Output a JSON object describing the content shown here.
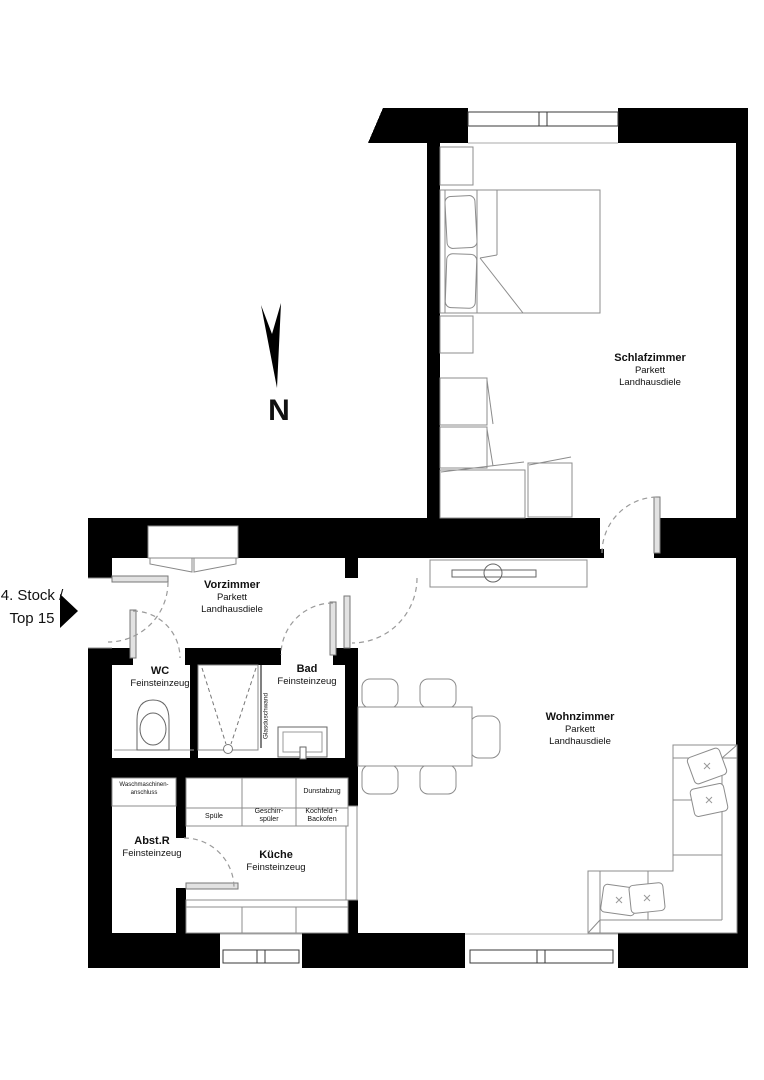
{
  "plan": {
    "floor": {
      "line1": "4. Stock /",
      "line2": "Top 15"
    },
    "north": "N",
    "rooms": {
      "schlafzimmer": {
        "name": "Schlafzimmer",
        "material1": "Parkett",
        "material2": "Landhausdiele"
      },
      "wohnzimmer": {
        "name": "Wohnzimmer",
        "material1": "Parkett",
        "material2": "Landhausdiele"
      },
      "vorzimmer": {
        "name": "Vorzimmer",
        "material1": "Parkett",
        "material2": "Landhausdiele"
      },
      "wc": {
        "name": "WC",
        "material1": "Feinsteinzeug"
      },
      "bad": {
        "name": "Bad",
        "material1": "Feinsteinzeug"
      },
      "abstr": {
        "name": "Abst.R",
        "material1": "Feinsteinzeug"
      },
      "kueche": {
        "name": "Küche",
        "material1": "Feinsteinzeug"
      }
    },
    "kitchen": {
      "spuele": "Spüle",
      "geschirr1": "Geschirr-",
      "geschirr2": "spüler",
      "dunstabzug": "Dunstabzug",
      "kochfeld1": "Kochfeld +",
      "kochfeld2": "Backofen",
      "wasch1": "Waschmaschinen-",
      "wasch2": "anschluss"
    },
    "bad_detail": {
      "glaswand": "Glasduschwand"
    },
    "colors": {
      "wall": "#000000",
      "furniture_line": "#8c8c8c",
      "dash_line": "#9a9a9a",
      "text": "#111111"
    }
  }
}
